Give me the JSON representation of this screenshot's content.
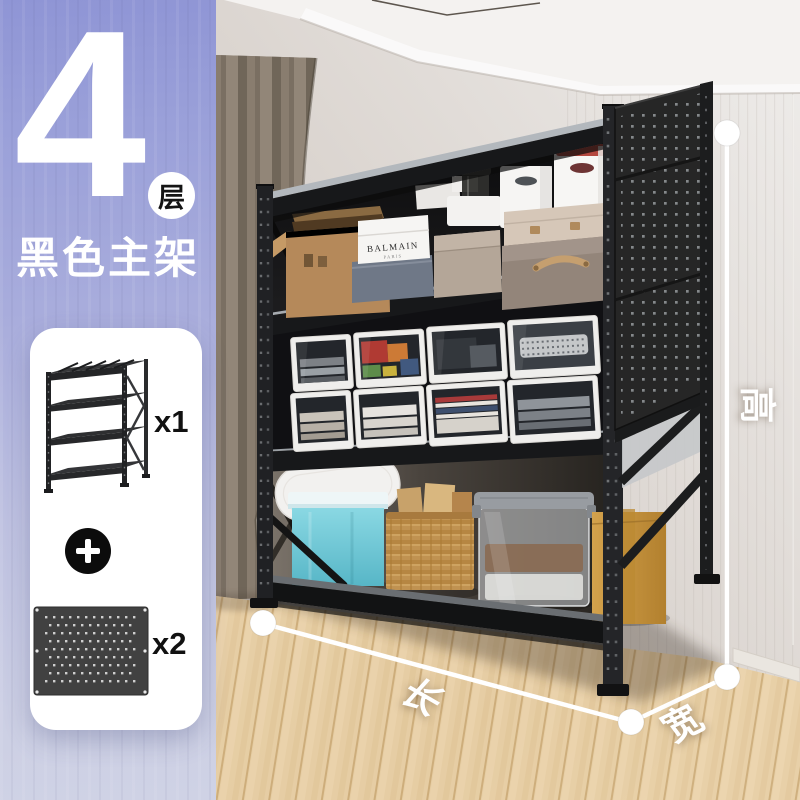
{
  "panel": {
    "tier_number": "4",
    "tier_unit": "层",
    "subtitle": "黑色主架",
    "bundle": {
      "main_rack_qty": "x1",
      "pegboard_qty": "x2"
    }
  },
  "dimensions": {
    "height_label": "高",
    "length_label": "长",
    "width_label": "宽"
  },
  "product_labels": {
    "shoebox_brand": "BALMAIN",
    "shoebox_sub": "PARIS",
    "recycle_symbol": "♻"
  },
  "icons": {
    "plus_icon": "plus-in-black-circle",
    "dimension_dot": "white-circle-endpoint"
  },
  "colors": {
    "panel_purple_top": "#8f95d5",
    "panel_purple_bottom": "#cfd2e5",
    "rack_black": "#1b1c1e",
    "shelf_lip_grey": "#a6abb0",
    "teal_bin": "#7fd0dd",
    "kraft_box": "#cf9c44",
    "wicker": "#c0914f",
    "floor_wood": "#e3c9a0",
    "curtain_taupe": "#7d7265",
    "dimension_white": "#ffffff"
  }
}
